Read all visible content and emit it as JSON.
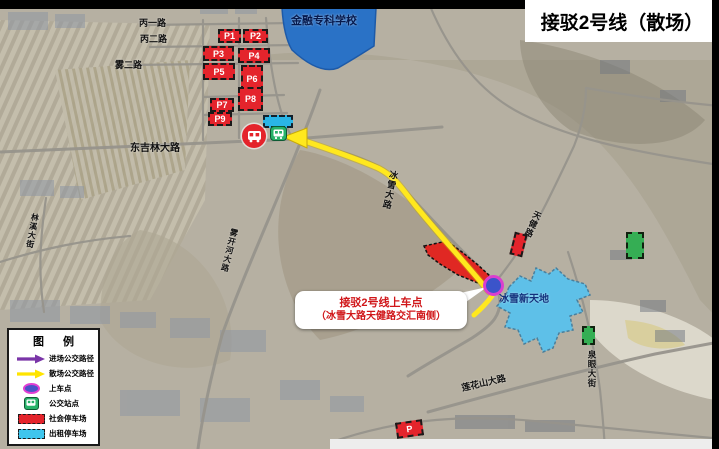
{
  "title": "接驳2号线（散场）",
  "map": {
    "school_label": "金融专科学校",
    "venue_label": "冰雪新天地",
    "roads": {
      "bing1": "丙一路",
      "bing2": "丙二路",
      "wu2": "雾二路",
      "dongjilin": "东吉林大路",
      "wukaihe": "雾开河大路",
      "linxi": "林溪大街",
      "bingxue": "冰雪大路",
      "tianjian": "天健路",
      "lianhuashan": "莲花山大路",
      "quanyan": "泉眼大街"
    },
    "parking_lots": [
      {
        "label": "P1"
      },
      {
        "label": "P2"
      },
      {
        "label": "P3"
      },
      {
        "label": "P4"
      },
      {
        "label": "P5"
      },
      {
        "label": "P6"
      },
      {
        "label": "P7"
      },
      {
        "label": "P8"
      },
      {
        "label": "P9"
      }
    ],
    "bottom_parking_label": "P"
  },
  "callout": {
    "line1": "接驳2号线上车点",
    "line2": "（冰雪大路天健路交汇南侧）"
  },
  "legend": {
    "title": "图  例",
    "items": [
      {
        "label": "进场公交路径",
        "icon": "purple-arrow"
      },
      {
        "label": "散场公交路径",
        "icon": "yellow-arrow"
      },
      {
        "label": "上车点",
        "icon": "blue-ellipse-magenta-border"
      },
      {
        "label": "公交站点",
        "icon": "green-bus"
      },
      {
        "label": "社会停车场",
        "icon": "red-dashed-rect"
      },
      {
        "label": "出租停车场",
        "icon": "cyan-dashed-rect"
      }
    ]
  },
  "colors": {
    "parking_red": "#e4242c",
    "taxi_cyan": "#3fc6ee",
    "route_yellow": "#ffe81e",
    "entry_purple": "#7a35a8",
    "boarding_blue": "#3b54ca",
    "boarding_border_magenta": "#db3ecf",
    "venue_blue": "#5ec0e8",
    "school_blue": "#2a72c6",
    "bus_stop_green": "#27b269",
    "callout_text_red": "#d01619"
  }
}
